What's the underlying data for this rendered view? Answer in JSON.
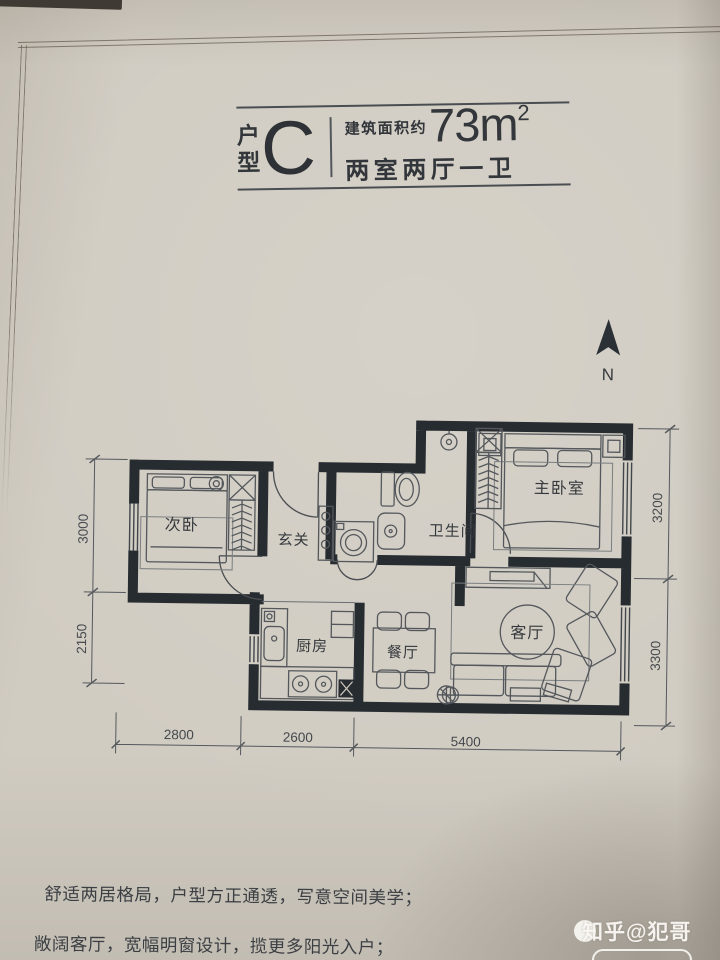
{
  "header": {
    "type_char_1": "户",
    "type_char_2": "型",
    "type_letter": "C",
    "area_label": "建筑面积约",
    "area_number": "73m",
    "area_exponent": "2",
    "layout_summary": "两室两厅一卫"
  },
  "compass": {
    "north_label": "N"
  },
  "floor_plan": {
    "rooms": [
      {
        "name": "secondary-bedroom",
        "label": "次卧"
      },
      {
        "name": "foyer",
        "label": "玄关"
      },
      {
        "name": "bathroom",
        "label": "卫生间"
      },
      {
        "name": "master-bedroom",
        "label": "主卧室"
      },
      {
        "name": "kitchen",
        "label": "厨房"
      },
      {
        "name": "dining-room",
        "label": "餐厅"
      },
      {
        "name": "living-room",
        "label": "客厅"
      }
    ],
    "dimensions": {
      "left": [
        "3000",
        "2150"
      ],
      "right": [
        "3200",
        "3300"
      ],
      "bottom": [
        "2800",
        "2600",
        "5400"
      ]
    }
  },
  "notes": {
    "line_1": "舒适两居格局，户型方正通透，写意空间美学；",
    "line_2": "敞阔客厅，宽幅明窗设计，揽更多阳光入户；"
  },
  "watermark": {
    "text": "知乎@犯哥"
  },
  "colors": {
    "paper": "#d1ccc2",
    "wall": "#272c31",
    "ink": "#3b3f43"
  }
}
